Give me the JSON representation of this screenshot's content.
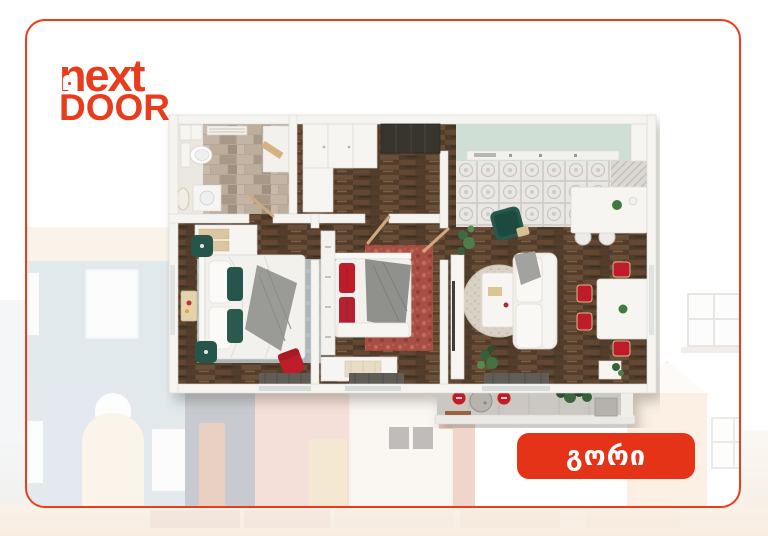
{
  "card": {
    "name": "promo-card",
    "background": "#ffffff",
    "border_color": "#f03a18"
  },
  "logo": {
    "line1": "next",
    "line2": "DOOR",
    "color": "#e83c1d"
  },
  "location_badge": {
    "label": "გორი",
    "background": "#e53317",
    "text_color": "#ffffff"
  },
  "floorplan": {
    "description": "3D top-down floor plan of a two-bedroom apartment with kitchen, living-dining room, bathroom and balcony",
    "rooms": [
      {
        "name": "bathroom"
      },
      {
        "name": "hallway"
      },
      {
        "name": "kitchen"
      },
      {
        "name": "living-dining-room"
      },
      {
        "name": "bedroom-1"
      },
      {
        "name": "bedroom-2"
      },
      {
        "name": "balcony"
      }
    ],
    "colors": {
      "wood_floor": "#5a4330",
      "walls": "#f6f4f1",
      "bathroom_tile": "#b6a796",
      "kitchen_counter": "#cfdfd5",
      "kitchen_tile": "#e9e7e3",
      "accent_red": "#bf1f2a",
      "accent_green": "#28564b",
      "rug_blue_gray": "#aab6b8",
      "rug_red": "#a85045",
      "balcony_floor": "#cbc8c3"
    }
  },
  "background_houses": {
    "visible": true,
    "palette": {
      "blue_house": "#ccd8e0",
      "roof_band": "#f6ead8",
      "slate_house": "#9aa2ad",
      "pink_house": "#ecc7ba",
      "white_house": "#f7f2ea",
      "peach_house": "#f7e3cc",
      "door_cream": "#f8ecd9"
    }
  }
}
